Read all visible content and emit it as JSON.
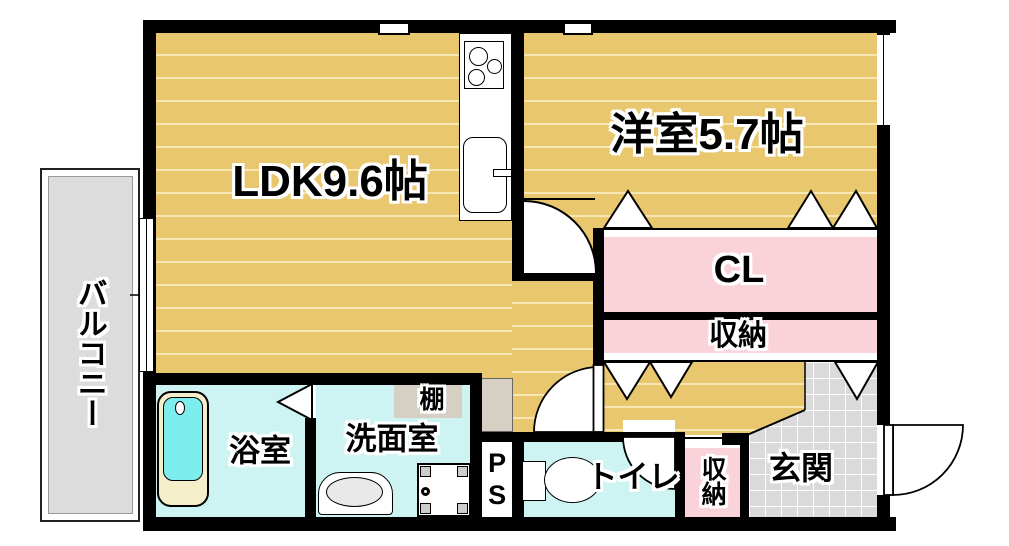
{
  "plan": {
    "labels": {
      "ldk": "LDK9.6帖",
      "western_room": "洋室5.7帖",
      "closet": "CL",
      "storage_upper": "収納",
      "balcony": "バルコニー",
      "bathroom": "浴室",
      "washroom": "洗面室",
      "shelf": "棚",
      "pipe_space": "PS",
      "toilet": "トイレ",
      "storage_lower": "収納",
      "entrance": "玄関"
    },
    "colors": {
      "wall": "#000000",
      "tatami_floor": "#e9c76f",
      "tatami_stripe": "#f6e7b5",
      "closet_pink": "#f9d3d9",
      "wet_room_cyan": "#cdf3f3",
      "bathtub_cyan": "#7deded",
      "bathtub_rim": "#f4eecb",
      "balcony_gray": "#dcdcdc",
      "entrance_tile": "#dadada",
      "shelf_beige": "#d5cfc4"
    }
  }
}
